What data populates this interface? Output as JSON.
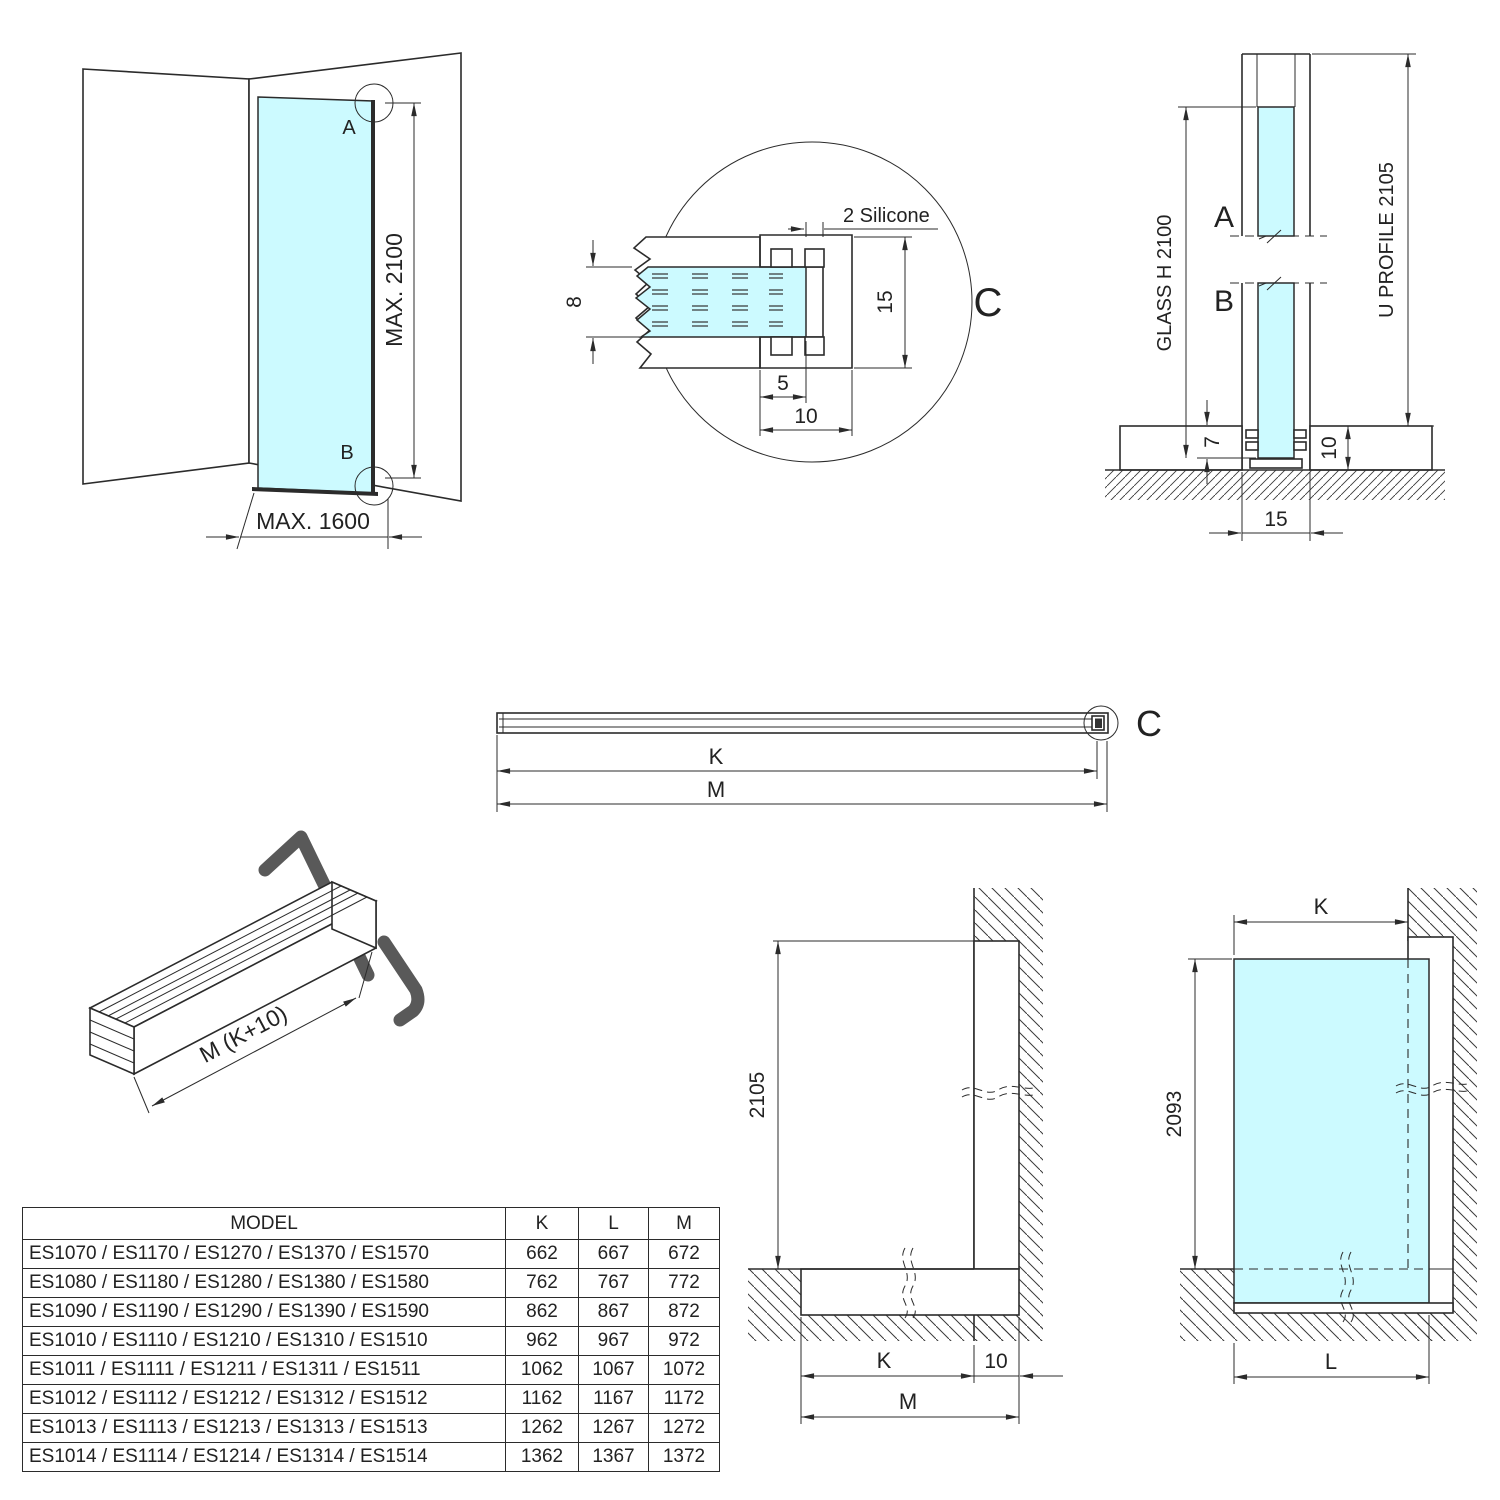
{
  "colors": {
    "glass": "#ccfaff",
    "line": "#2b2b2b",
    "end_cap_gray": "#595959"
  },
  "perspective_view": {
    "label_a": "A",
    "label_b": "B",
    "max_height": "MAX. 2100",
    "max_width": "MAX. 1600"
  },
  "detail_c": {
    "label": "C",
    "silicone": "2 Silicone",
    "glass_thickness": "8",
    "profile_height": "15",
    "glass_inset": "5",
    "profile_depth": "10"
  },
  "vertical_section": {
    "label_a": "A",
    "label_b": "B",
    "glass_height": "GLASS H 2100",
    "profile_height": "U PROFILE 2105",
    "inset_depth": "7",
    "base_height": "10",
    "base_width": "15"
  },
  "profile_top_view": {
    "detail_label": "C",
    "k": "K",
    "m": "M"
  },
  "profile_3d": {
    "length_label": "M (K+10)"
  },
  "wall_elevation": {
    "height": "2105",
    "k": "K",
    "offset": "10",
    "m": "M"
  },
  "glass_elevation": {
    "k": "K",
    "height": "2093",
    "l": "L"
  },
  "table": {
    "headers": [
      "MODEL",
      "K",
      "L",
      "M"
    ],
    "rows": [
      {
        "model": "ES1070 / ES1170 / ES1270 / ES1370 / ES1570",
        "k": "662",
        "l": "667",
        "m": "672"
      },
      {
        "model": "ES1080 / ES1180 / ES1280 / ES1380 / ES1580",
        "k": "762",
        "l": "767",
        "m": "772"
      },
      {
        "model": "ES1090 / ES1190 / ES1290 / ES1390 / ES1590",
        "k": "862",
        "l": "867",
        "m": "872"
      },
      {
        "model": "ES1010 / ES1110 / ES1210 / ES1310 / ES1510",
        "k": "962",
        "l": "967",
        "m": "972"
      },
      {
        "model": "ES1011 / ES1111 / ES1211 / ES1311 / ES1511",
        "k": "1062",
        "l": "1067",
        "m": "1072"
      },
      {
        "model": "ES1012 / ES1112 / ES1212 / ES1312 / ES1512",
        "k": "1162",
        "l": "1167",
        "m": "1172"
      },
      {
        "model": "ES1013 / ES1113 / ES1213 / ES1313 / ES1513",
        "k": "1262",
        "l": "1267",
        "m": "1272"
      },
      {
        "model": "ES1014 / ES1114 / ES1214 / ES1314 / ES1514",
        "k": "1362",
        "l": "1367",
        "m": "1372"
      }
    ]
  }
}
